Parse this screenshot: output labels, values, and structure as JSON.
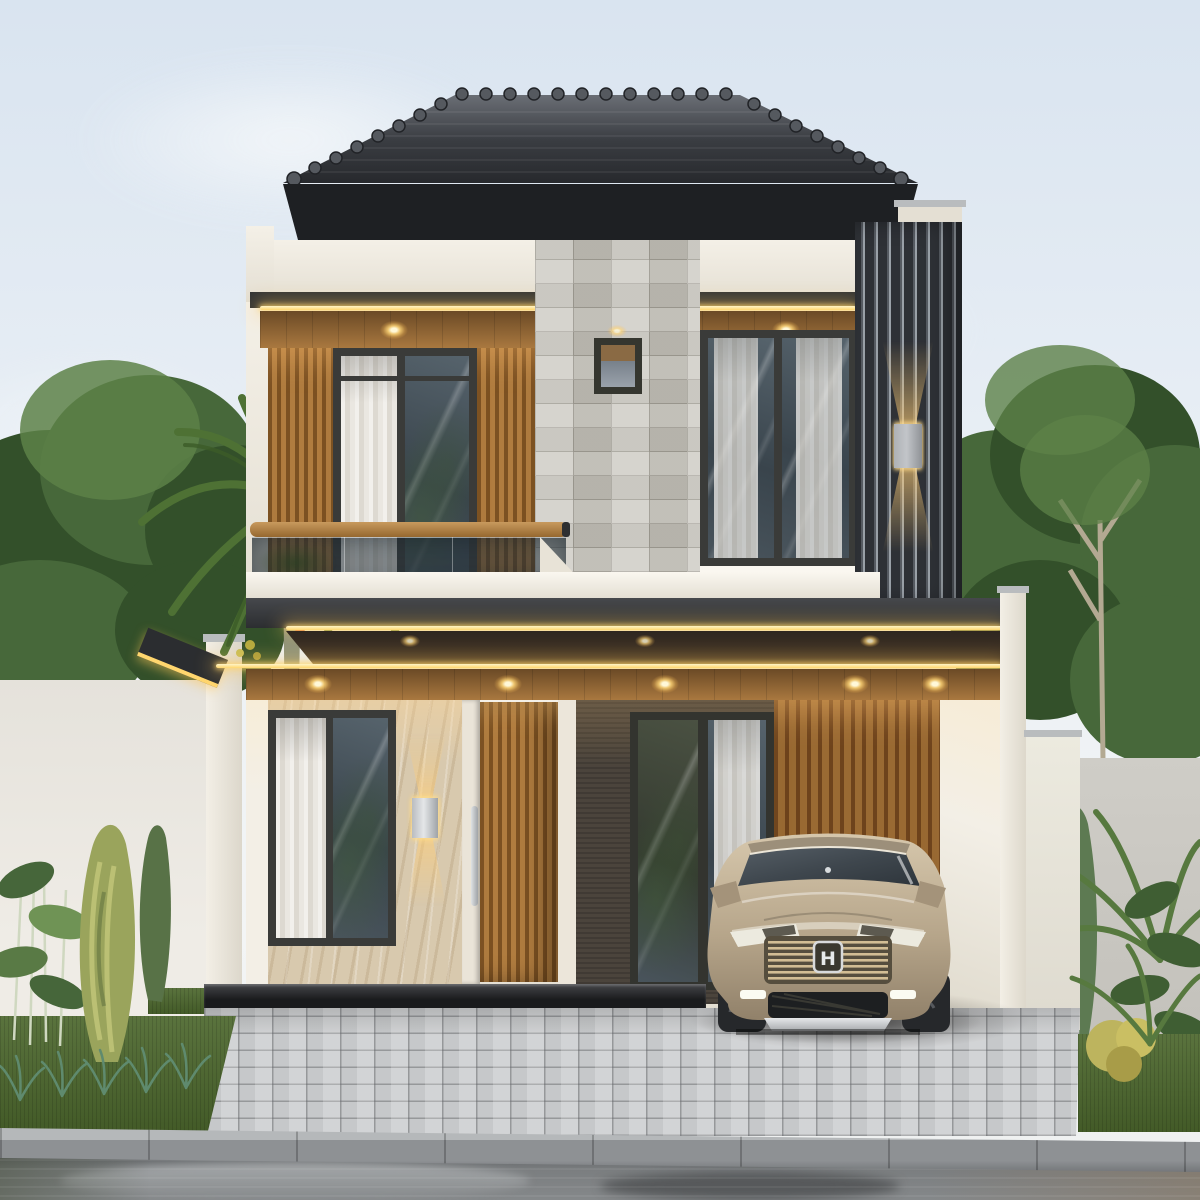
{
  "meta": {
    "title": "Photoreal exterior render of a modern two-storey tropical-minimalist house at dusk",
    "canvas": "1200x1200"
  },
  "scene": {
    "sky": "pale overcast blue-white sky",
    "house": {
      "roof": "dark grey hip roof with round ridge caps and black fascia",
      "second_floor": [
        "white parapet band",
        "warm LED cove strip with three recessed downlights under wood soffit",
        "vertical wood-slat panels flanking left window",
        "dark-framed sliding window with sheer curtain",
        "grey stone-tile feature wall with small lit window",
        "second dark-framed window with curtains",
        "dark vertical louver screen on right corner with up/down wall sconce",
        "glass balcony railing with timber handrail"
      ],
      "first_floor": [
        "double stacked canopy outlined with warm LED strips and five downlights",
        "dark-framed window with sheer curtain",
        "travertine wall with up/down sconce",
        "timber-slat entry door with stainless pull handle",
        "dark textured wall with glass sliding door",
        "timber-slat carport wall",
        "white carport walls and pillars"
      ]
    },
    "car": {
      "emblem": "H",
      "description": "champagne-beige compact SUV parked in the carport facing the street"
    },
    "landscape": [
      "palm tree with red fruit clusters over left boundary wall",
      "dense background trees both sides",
      "golden juniper, cypress, ferns and bamboo in left planting bed",
      "conifer, palm fronds, rubber plant and golden shrub on right",
      "lawn beds",
      "grey interlocking paver driveway",
      "black stone entry step",
      "white and grey boundary walls",
      "concrete curb",
      "wet reflective asphalt road"
    ]
  },
  "colors": {
    "sky_top": "#d9e4f0",
    "sky_mid": "#e9eff5",
    "sky_low": "#f3f5f5",
    "cloud": "#f8fafb",
    "roof_light": "#6a6e75",
    "roof_mid": "#3a3d42",
    "roof_dark": "#26282c",
    "fascia": "#1e2023",
    "white_warm": "#f4f0e7",
    "white_shade": "#e4dfd3",
    "white_bright": "#faf7f0",
    "band_dark_a": "#46484c",
    "band_dark_b": "#2c2e31",
    "led": "#ffd66e",
    "led_core": "#fff4c6",
    "soffit_shadow_a": "#2e2620",
    "soffit_shadow_b": "#4a3a28",
    "soffit_wood_a": "#a9783f",
    "soffit_wood_b": "#6b4a26",
    "stone_base": "#c9c6be",
    "stone_line": "#a5a299",
    "frame_dark": "#3a3b39",
    "glass_a": "#56636c",
    "glass_b": "#39444c",
    "marble_base": "#d8c9ae",
    "marble_vein": "#bfab8c",
    "dark_wall": "#4b443c",
    "door_wood_a": "#b07c3f",
    "door_wood_b": "#7c5122",
    "carport_wood_a": "#9a6a33",
    "carport_wood_b": "#6e431c",
    "louver_dark": "#2e3136",
    "louver_mid": "#565b62",
    "louver_gap": "#9aa1a8",
    "rail_wood_a": "#c89a5e",
    "rail_wood_b": "#96682f",
    "sconce_metal": "#c2c5c9",
    "handle_silver": "#dfe2e4",
    "wall_left": "#e5e2db",
    "wall_right_gray": "#cfcdc7",
    "pillar_white": "#f3efe6",
    "cap_gray": "#b9bcbe",
    "step_a": "#313236",
    "step_b": "#1a1b1d",
    "grass_a": "#4c672d",
    "grass_b": "#3b5423",
    "paver_base": "#c6c8ca",
    "curb_top": "#b5b8ba",
    "curb_face": "#8e9194",
    "road": "#7b7e80",
    "road_light": "#aaadaf",
    "road_dark": "#5a5d60",
    "road_brown": "#8d7a62",
    "leaf_dark": "#33502a",
    "leaf_mid": "#47683a",
    "leaf_light": "#5d8148",
    "palm_green": "#4e7134",
    "trunk": "#8d927b",
    "branch": "#b3a992",
    "berry_red": "#c83d28",
    "gold_leaf": "#bdb45e",
    "fern_teal": "#5f8a6e",
    "car_body_a": "#d6c7ac",
    "car_body_b": "#b6a58a",
    "car_body_c": "#91816a",
    "car_glass": "#3f474e",
    "car_roof": "#9c8f7a",
    "chrome": "#d8dadc",
    "tire": "#26282b",
    "intake_dark": "#1d1f21",
    "emblem_bg": "#3a382f",
    "grille_bar": "#d2bd94"
  }
}
